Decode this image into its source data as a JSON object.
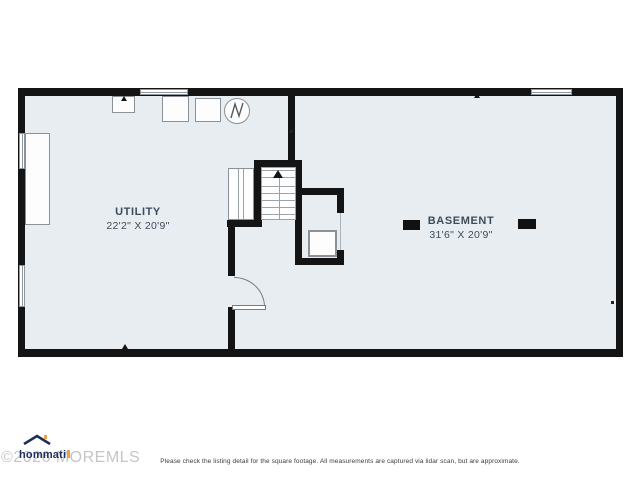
{
  "page": {
    "background": "#ffffff",
    "wall_color": "#141414",
    "floor_color": "#e8edf2",
    "label_color": "#3d4c5a"
  },
  "floor_plan": {
    "type": "basement-floor-plan",
    "rooms": [
      {
        "id": "utility",
        "name": "UTILITY",
        "dimensions": "22'2\" X 20'9\""
      },
      {
        "id": "basement",
        "name": "BASEMENT",
        "dimensions": "31'6\" X 20'9\""
      }
    ],
    "fixtures": [
      "water-heater",
      "appliance-square-1",
      "appliance-square-2",
      "sink-unit",
      "storage-tank",
      "closet-shelves",
      "staircase-up",
      "sump-pit-box",
      "entry-door",
      "support-column-left",
      "support-column-right"
    ],
    "windows": [
      "top-left-window",
      "top-right-window",
      "left-upper-window",
      "left-lower-window"
    ]
  },
  "branding": {
    "logo_text": "hommati",
    "logo_navy": "#1d2e5c",
    "logo_orange": "#f0a03c"
  },
  "watermark": {
    "text": "©2026 MOREMLS"
  },
  "footer": {
    "disclaimer": "Please check the listing detail for the square footage. All measurements are captured via lidar scan, but are approximate."
  }
}
